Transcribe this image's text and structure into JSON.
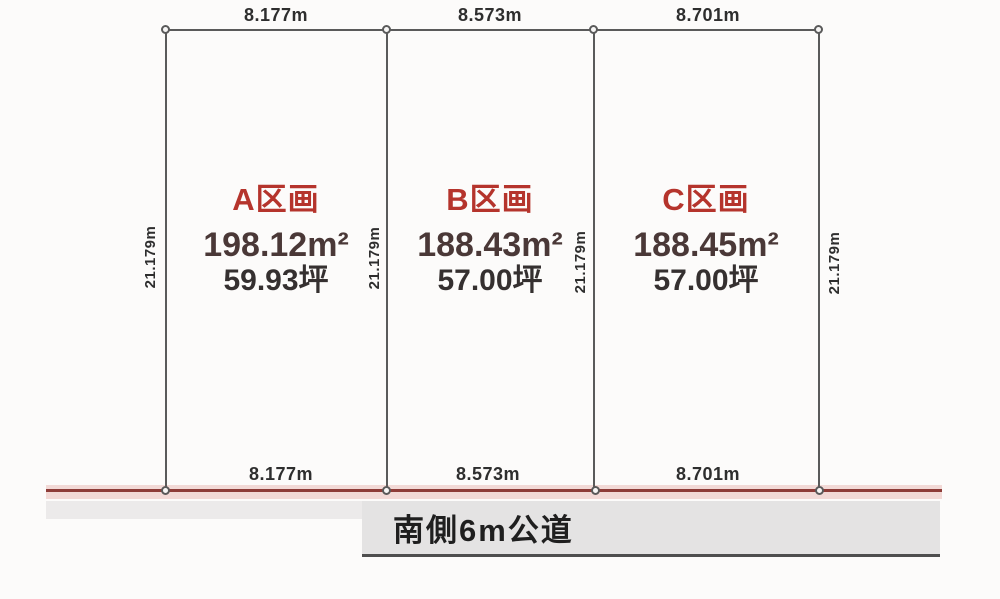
{
  "diagram": {
    "title": "land-subdivision-plan",
    "top_dimensions": [
      {
        "label": "8.177m"
      },
      {
        "label": "8.573m"
      },
      {
        "label": "8.701m"
      }
    ],
    "bottom_dimensions": [
      {
        "label": "8.177m"
      },
      {
        "label": "8.573m"
      },
      {
        "label": "8.701m"
      }
    ],
    "depth_dimensions": [
      {
        "label": "21.179m"
      },
      {
        "label": "21.179m"
      },
      {
        "label": "21.179m"
      },
      {
        "label": "21.179m"
      }
    ],
    "plots": [
      {
        "name": "A区画",
        "area_m2": "198.12m²",
        "area_tsubo": "59.93坪"
      },
      {
        "name": "B区画",
        "area_m2": "188.43m²",
        "area_tsubo": "57.00坪"
      },
      {
        "name": "C区画",
        "area_m2": "188.45m²",
        "area_tsubo": "57.00坪"
      }
    ],
    "road": {
      "label": "南側6m公道"
    },
    "colors": {
      "bg": "#fcfbfa",
      "boundary": "#5a5a5a",
      "dimension_text": "#2e2e2e",
      "plot_name": "#b5342c",
      "area_text": "#4a3837",
      "tsubo_text": "#353030",
      "road_line": "#8e3c38",
      "road_line_glow": "#f2d9d6",
      "road_strip": "#eceaea",
      "road_box": "#e4e3e3",
      "road_box_edge": "#4e4e4e"
    }
  }
}
